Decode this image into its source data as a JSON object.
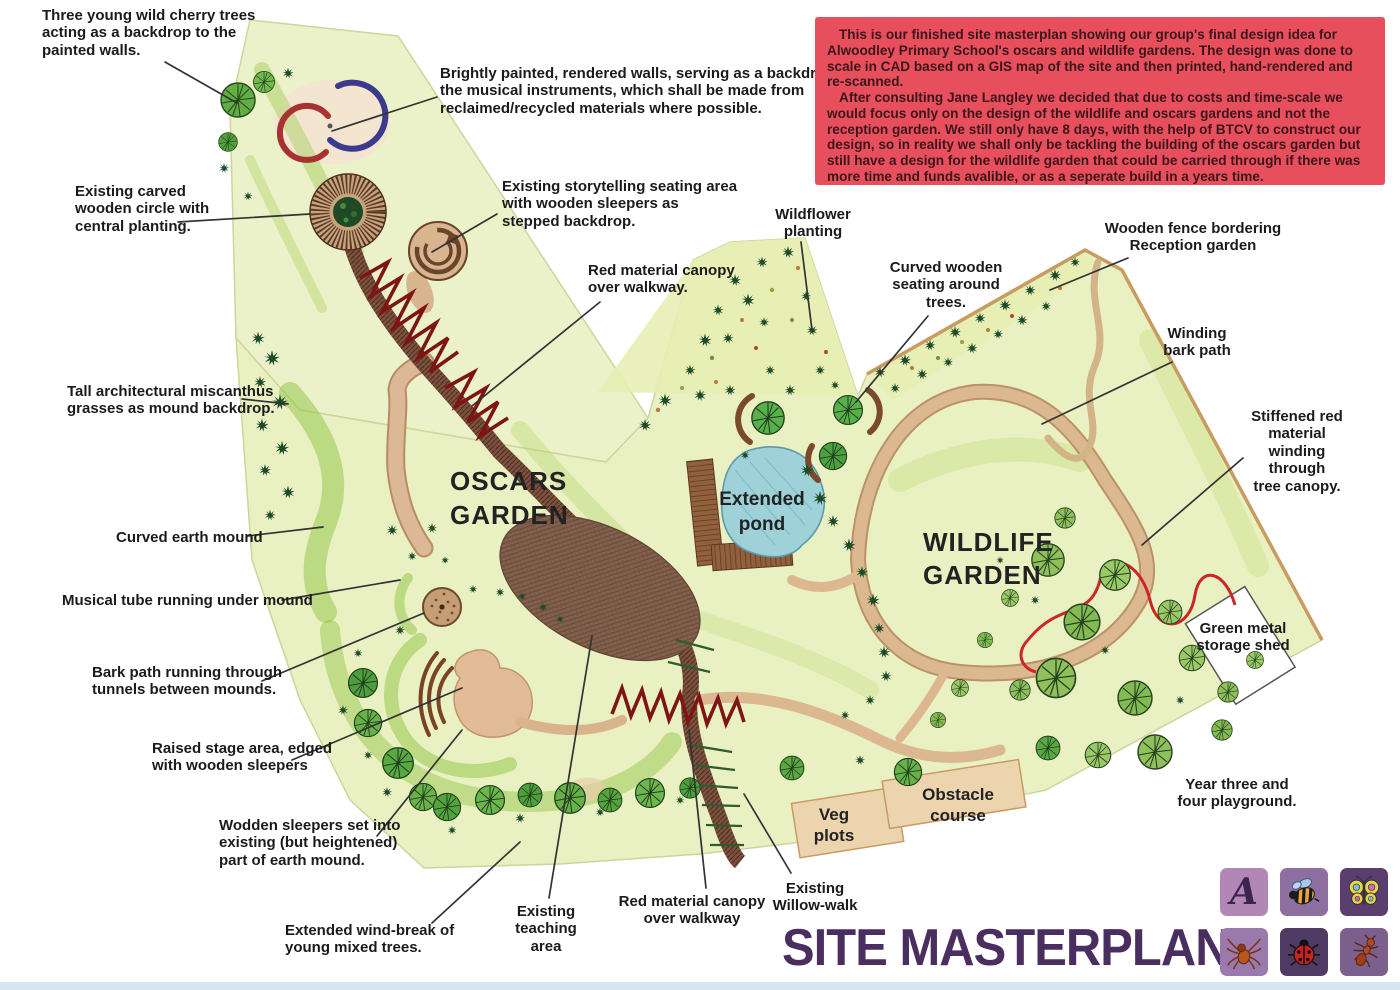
{
  "meta": {
    "page_kind": "hand-rendered landscape site plan"
  },
  "intro_box": {
    "bg": "#e84f5d",
    "text_color": "#3c151c",
    "paragraphs": [
      "This is our finished site masterplan showing our group's final design idea for Alwoodley Primary School's oscars and wildlife gardens. The design was done to scale in CAD based on a GIS map of the site and then printed, hand-rendered and re-scanned.",
      "After consulting Jane Langley we decided that due to costs and time-scale we would focus only on the design of the wildlife and oscars gardens and not the reception garden. We still only have 8 days, with the help of BTCV to construct our design, so in reality we shall only be tackling the building of the oscars garden but still have a design for the wildlife garden that could be carried through if there was more time and funds avalible, or as a seperate build in a years time."
    ]
  },
  "title": {
    "text": "SITE MASTERPLAN",
    "color": "#4b2e60"
  },
  "plan_labels": {
    "oscars": "OSCARS\nGARDEN",
    "wildlife": "WILDLIFE\nGARDEN",
    "pond": "Extended\npond",
    "veg": "Veg\nplots",
    "obstacle": "Obstacle\ncourse"
  },
  "annotations": [
    {
      "id": "cherry-trees",
      "text": "Three young wild cherry trees\nacting as a backdrop to the\npainted walls."
    },
    {
      "id": "painted-walls",
      "text": "Brightly painted, rendered walls, serving as a backdrop to\nthe musical instruments, which shall be made from\nreclaimed/recycled materials where possible."
    },
    {
      "id": "carved-circle",
      "text": "Existing carved\nwooden circle with\ncentral planting."
    },
    {
      "id": "storytelling",
      "text": "Existing storytelling seating area\nwith wooden sleepers as\nstepped backdrop."
    },
    {
      "id": "canopy-upper",
      "text": "Red material canopy\nover walkway."
    },
    {
      "id": "wildflower",
      "text": "Wildflower\nplanting"
    },
    {
      "id": "curved-seating",
      "text": "Curved wooden\nseating around\ntrees."
    },
    {
      "id": "fence",
      "text": "Wooden fence bordering\nReception garden"
    },
    {
      "id": "winding-bark",
      "text": "Winding\nbark path"
    },
    {
      "id": "stiffened-red",
      "text": "Stiffened red material\nwinding through\ntree canopy."
    },
    {
      "id": "miscanthus",
      "text": "Tall architectural miscanthus\ngrasses as mound backdrop."
    },
    {
      "id": "earth-mound",
      "text": "Curved earth mound"
    },
    {
      "id": "musical-tube",
      "text": "Musical tube running under mound"
    },
    {
      "id": "bark-tunnels",
      "text": "Bark path running through\ntunnels between mounds."
    },
    {
      "id": "raised-stage",
      "text": "Raised stage area, edged\nwith wooden sleepers"
    },
    {
      "id": "wooden-sleepers",
      "text": "Wodden sleepers set into\nexisting (but heightened)\npart of earth mound."
    },
    {
      "id": "wind-break",
      "text": "Extended wind-break of\nyoung mixed trees."
    },
    {
      "id": "teaching-area",
      "text": "Existing\nteaching\narea"
    },
    {
      "id": "canopy-lower",
      "text": "Red material canopy\nover walkway"
    },
    {
      "id": "willow-walk",
      "text": "Existing\nWillow-walk"
    },
    {
      "id": "storage-shed",
      "text": "Green metal\nstorage shed"
    },
    {
      "id": "playground",
      "text": "Year three and\nfour playground."
    }
  ],
  "icon_tiles": [
    {
      "name": "school-logo-a",
      "bg": "#b287b5",
      "glyph": "A"
    },
    {
      "name": "bee",
      "bg": "#8d6fa0"
    },
    {
      "name": "butterfly",
      "bg": "#5a3f6e"
    },
    {
      "name": "spider",
      "bg": "#9a7aac"
    },
    {
      "name": "ladybird",
      "bg": "#4e3a63"
    },
    {
      "name": "ant",
      "bg": "#7b5f8d"
    }
  ],
  "palette": {
    "grass_base": "#e9f0c2",
    "grass_swirl": "#8dc442",
    "path_tan": "#d9b68e",
    "walkway_brown": "#7b5140",
    "canopy_red": "#7e1414",
    "ribbon_red": "#cc2626",
    "pond_blue": "#9ed2d8",
    "fence_tan": "#c89c60",
    "leader_line": "#333333",
    "bottom_strip": "#d6e5f1"
  }
}
